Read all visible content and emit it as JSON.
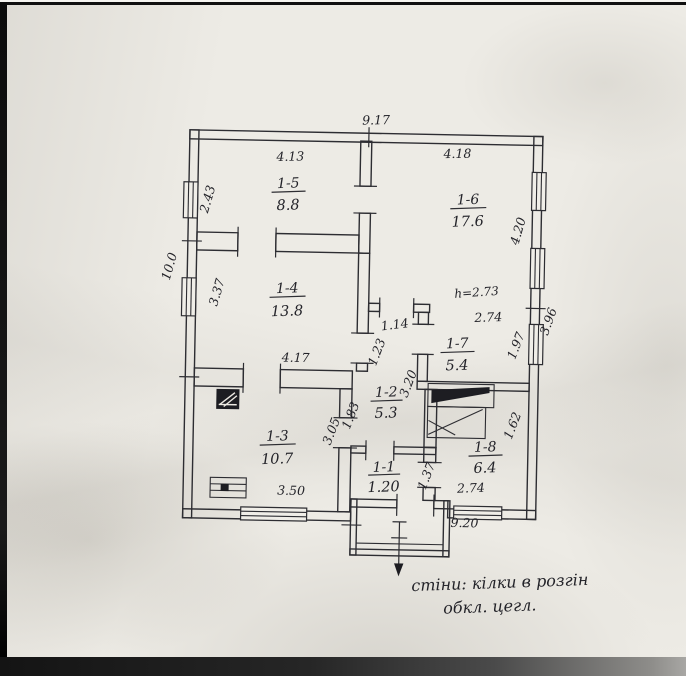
{
  "page": {
    "paper_color": "#edebe5",
    "ink_color": "#2d2d32",
    "frame_color": "#101010"
  },
  "plan": {
    "rooms": [
      {
        "id": "1-5",
        "area": "8.8"
      },
      {
        "id": "1-6",
        "area": "17.6"
      },
      {
        "id": "1-4",
        "area": "13.8"
      },
      {
        "id": "1-7",
        "area": "5.4"
      },
      {
        "id": "1-2",
        "area": "5.3"
      },
      {
        "id": "1-3",
        "area": "10.7"
      },
      {
        "id": "1-1",
        "area": "1.20"
      },
      {
        "id": "1-8",
        "area": "6.4"
      }
    ],
    "dimensions": {
      "overall_top": "9.17",
      "overall_bottom": "9.20",
      "overall_left": "10.0",
      "right_side": "3.96",
      "r5_top": "4.13",
      "r5_left": "2.43",
      "r6_top": "4.18",
      "r6_right_windows": "4.20",
      "r4_left": "3.37",
      "r4_bottom": "4.17",
      "hall_width": "1.14",
      "hall_height": "1.23",
      "corridor_length": "3.20",
      "r3_door_side": "3.05",
      "r3_upper_side": "1.83",
      "r3_bottom": "3.50",
      "r7_top": "2.74",
      "r7_right": "1.97",
      "r1_side": "1.37",
      "r8_right": "1.62",
      "r8_bottom": "2.74",
      "ceiling_height": "h=2.73"
    },
    "note": {
      "line1": "стіни: кілки в розгін",
      "line2": "обкл. цегл."
    }
  }
}
